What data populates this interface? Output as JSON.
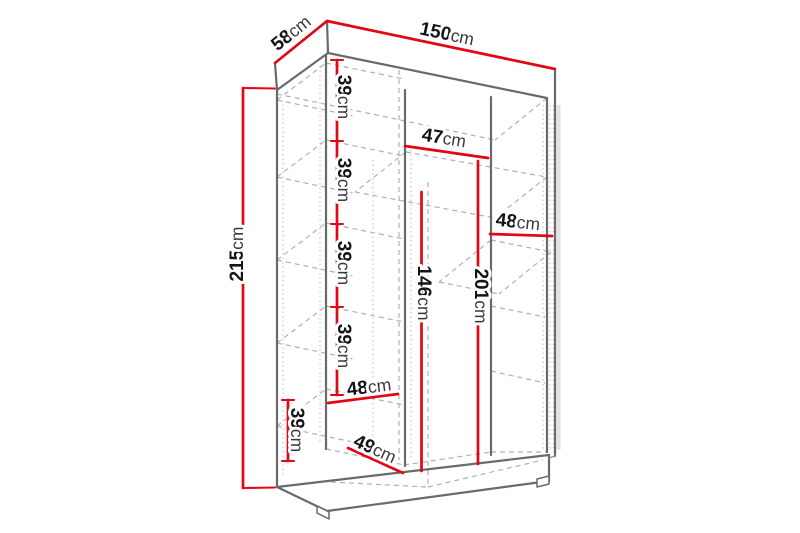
{
  "figure": {
    "kind": "furniture dimension diagram",
    "subject": "three-section wardrobe line drawing with red measurement lines",
    "unit": "cm",
    "canvas": {
      "width": 800,
      "height": 533,
      "background": "#ffffff"
    }
  },
  "colors": {
    "dimension_red": "#e30613",
    "outline_gray": "#6a6a6a",
    "hidden_dash_gray": "#b0b0b0",
    "label_text": "#141414"
  },
  "dims": {
    "d150": {
      "num": "150",
      "unit": "cm",
      "label": "150cm"
    },
    "d58": {
      "num": "58",
      "unit": "cm",
      "label": "58cm"
    },
    "d215": {
      "num": "215",
      "unit": "cm",
      "label": "215cm"
    },
    "d39_1": {
      "num": "39",
      "unit": "cm",
      "label": "39cm"
    },
    "d39_2": {
      "num": "39",
      "unit": "cm",
      "label": "39cm"
    },
    "d39_3": {
      "num": "39",
      "unit": "cm",
      "label": "39cm"
    },
    "d39_4": {
      "num": "39",
      "unit": "cm",
      "label": "39cm"
    },
    "d47": {
      "num": "47",
      "unit": "cm",
      "label": "47cm"
    },
    "d48_right": {
      "num": "48",
      "unit": "cm",
      "label": "48cm"
    },
    "d201": {
      "num": "201",
      "unit": "cm",
      "label": "201cm"
    },
    "d146": {
      "num": "146",
      "unit": "cm",
      "label": "146cm"
    },
    "d48_bottom": {
      "num": "48",
      "unit": "cm",
      "label": "48cm"
    },
    "d39_bottom": {
      "num": "39",
      "unit": "cm",
      "label": "39cm"
    },
    "d49": {
      "num": "49",
      "unit": "cm",
      "label": "49cm"
    }
  },
  "measurement_values_cm": [
    150,
    58,
    215,
    39,
    39,
    39,
    39,
    47,
    48,
    201,
    146,
    48,
    39,
    49
  ]
}
